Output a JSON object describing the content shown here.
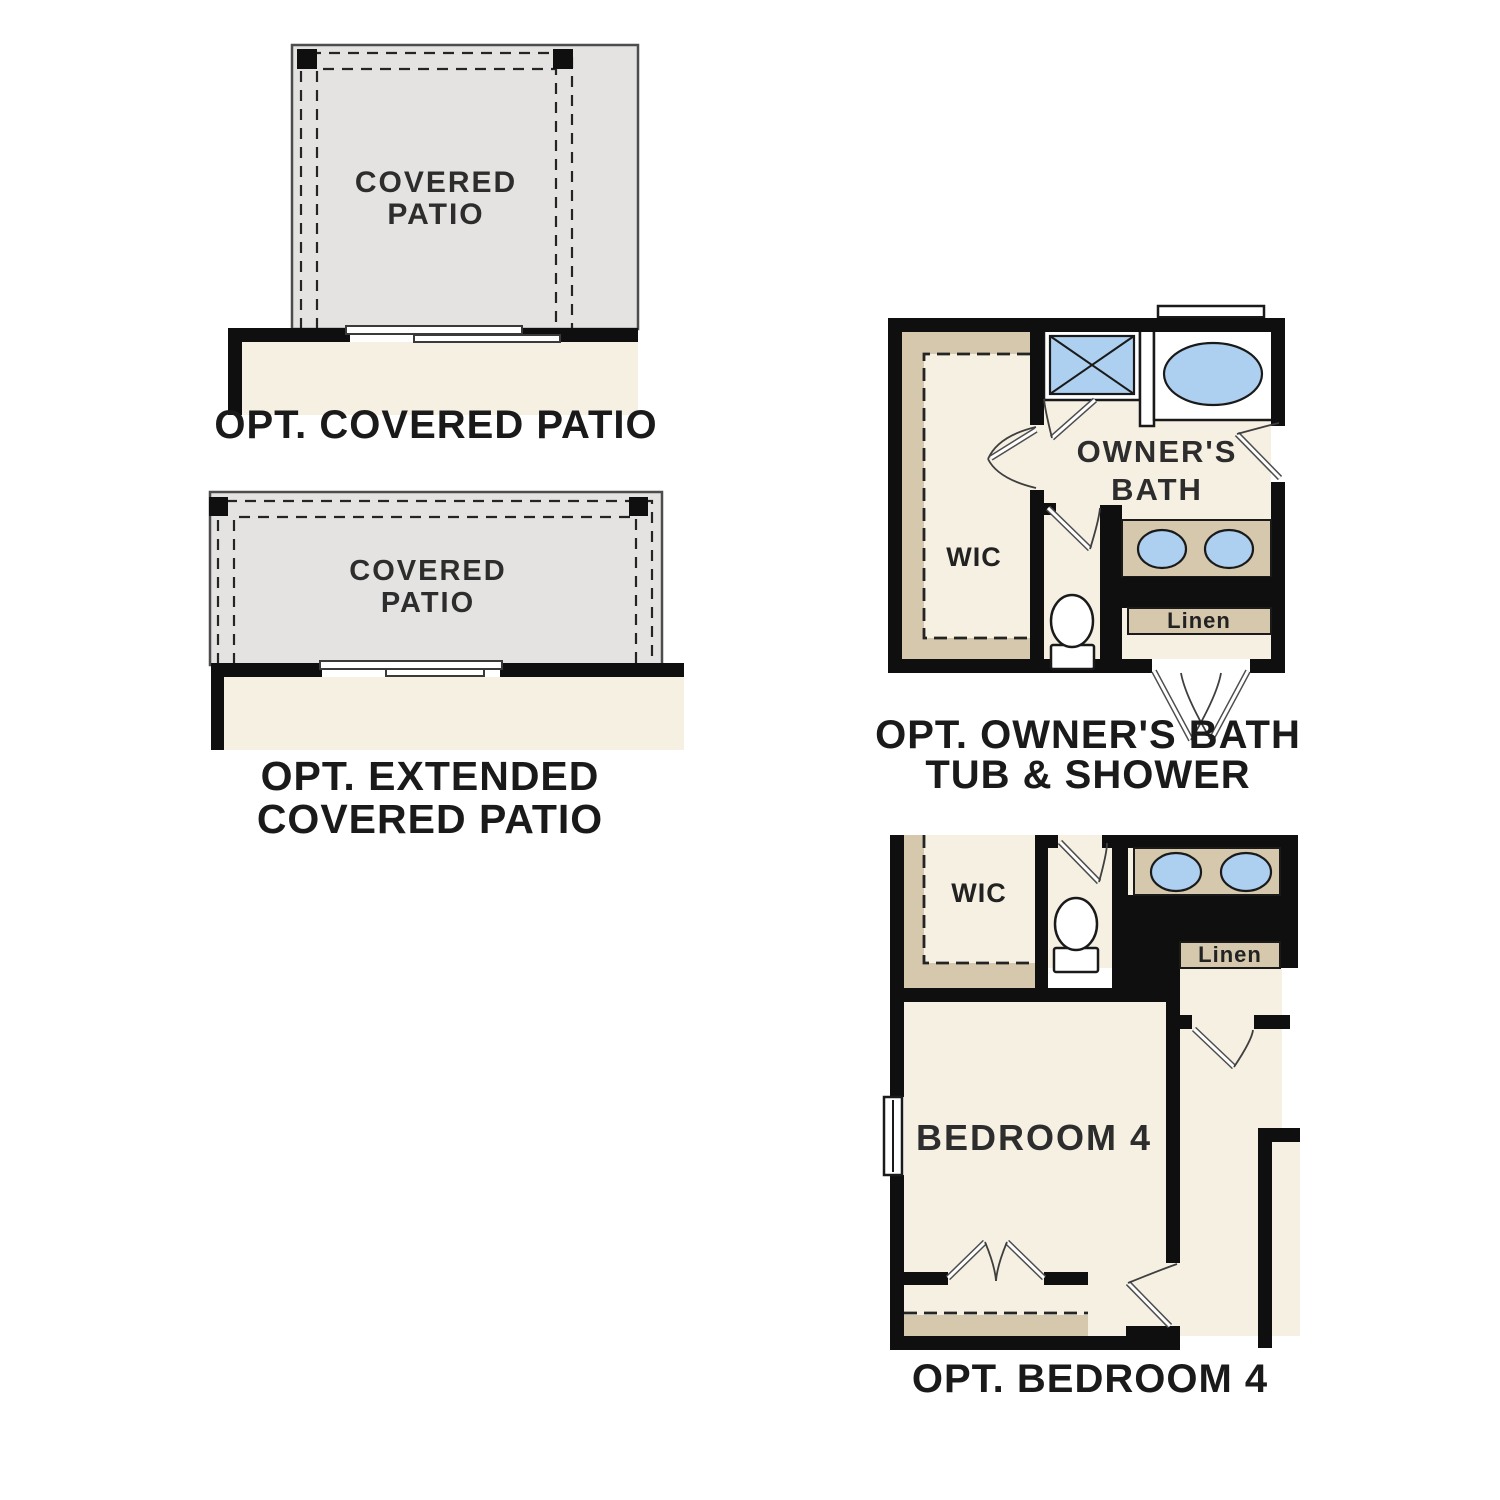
{
  "colors": {
    "wall": "#0f0f0f",
    "floor": "#f6f0e3",
    "patio": "#e4e3e1",
    "shelf": "#d5c8ac",
    "fixture": "#aed0f0",
    "caption": "#1a1a1a"
  },
  "figures": {
    "covered_patio": {
      "room": {
        "line1": "COVERED",
        "line2": "PATIO"
      },
      "caption": "OPT. COVERED PATIO"
    },
    "extended_patio": {
      "room": {
        "line1": "COVERED",
        "line2": "PATIO"
      },
      "caption": {
        "line1": "OPT. EXTENDED",
        "line2": "COVERED PATIO"
      }
    },
    "owners_bath": {
      "room": {
        "line1": "OWNER'S",
        "line2": "BATH"
      },
      "wic": "WIC",
      "linen": "Linen",
      "caption": {
        "line1": "OPT. OWNER'S BATH",
        "line2": "TUB & SHOWER"
      }
    },
    "bedroom4": {
      "room": "BEDROOM 4",
      "wic": "WIC",
      "linen": "Linen",
      "caption": "OPT. BEDROOM 4"
    }
  }
}
